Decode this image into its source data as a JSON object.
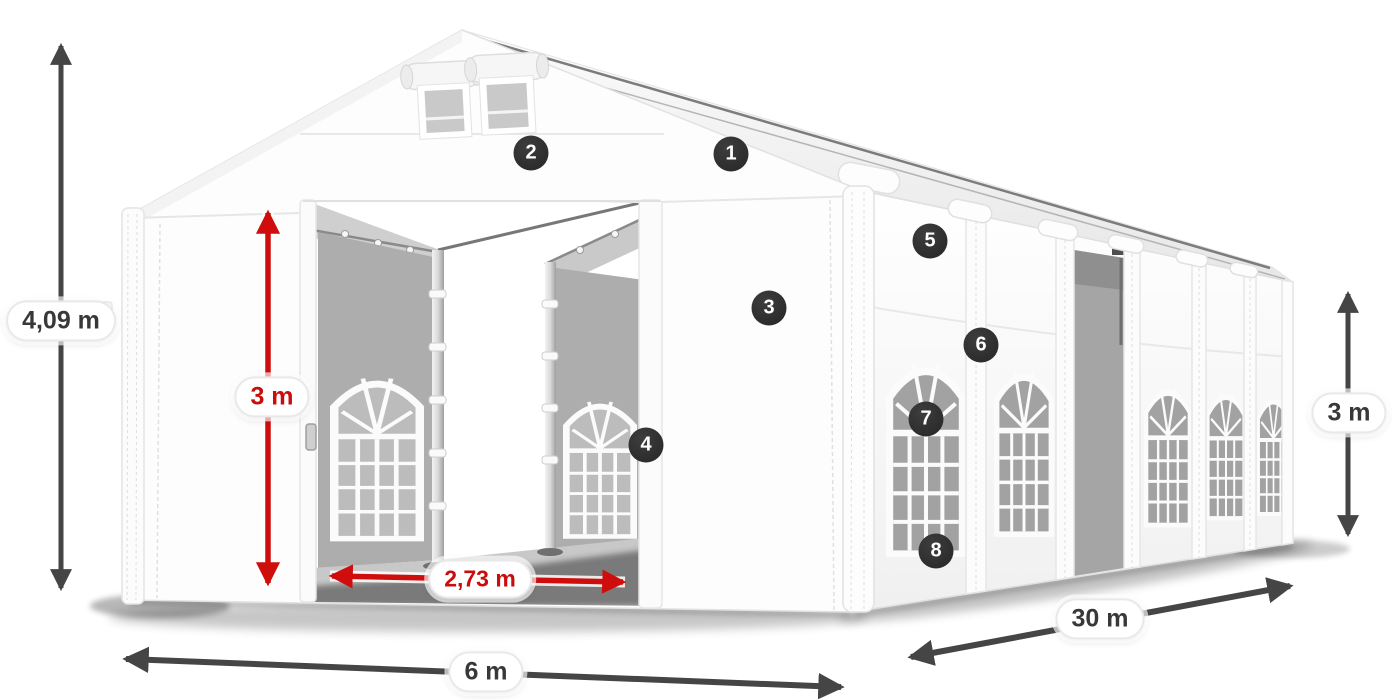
{
  "diagram": {
    "type": "product-dimension-diagram",
    "subject": "white storage / party tent with windows",
    "dimensions": {
      "total_height": "4,09 m",
      "door_height": "3 m",
      "door_width": "2,73 m",
      "front_width": "6 m",
      "length": "30 m",
      "side_height": "3 m"
    },
    "hotspots": [
      {
        "number": "1"
      },
      {
        "number": "2"
      },
      {
        "number": "3"
      },
      {
        "number": "4"
      },
      {
        "number": "5"
      },
      {
        "number": "6"
      },
      {
        "number": "7"
      },
      {
        "number": "8"
      }
    ],
    "colors": {
      "dimension_arrow_gray": "#454545",
      "dimension_arrow_red": "#cf0d0d",
      "badge_background": "#2d2d2d",
      "label_text": "#383838",
      "tent_white": "#fdfdfd",
      "interior_gray": "#adadad"
    }
  }
}
